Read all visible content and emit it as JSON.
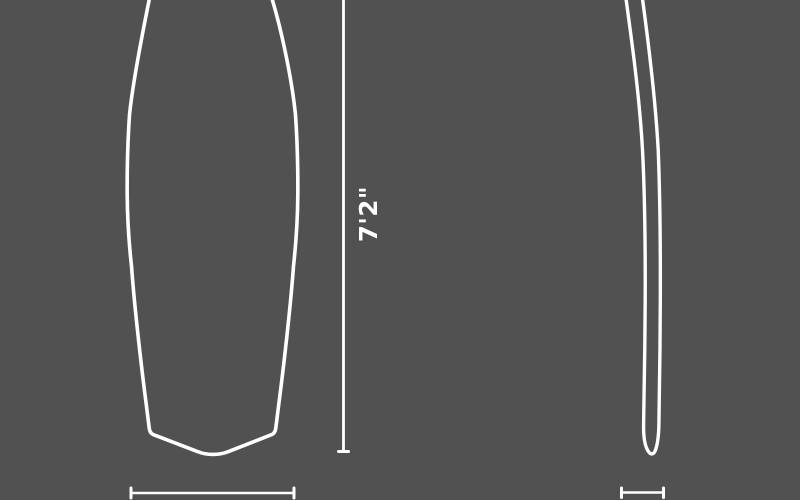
{
  "diagram": {
    "type": "product-dimension-diagram",
    "subject": "surfboard",
    "length_label": "7'2\"",
    "colors": {
      "background": "#515151",
      "line": "#ffffff",
      "text": "#ffffff"
    }
  }
}
